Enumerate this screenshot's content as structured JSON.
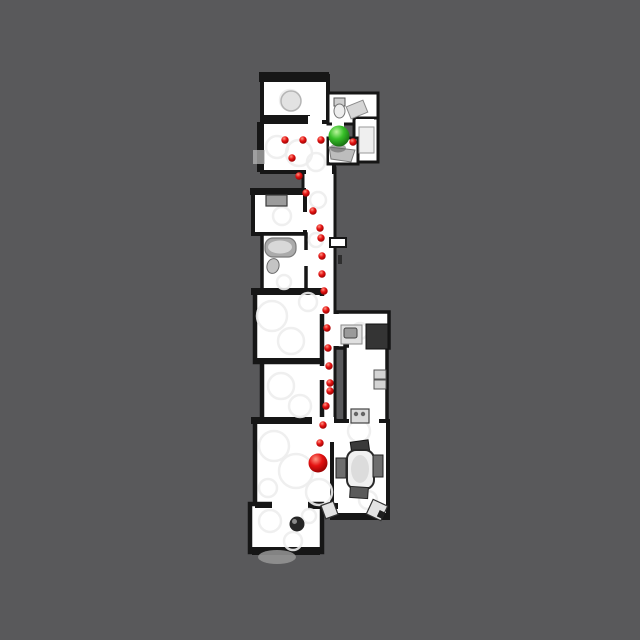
{
  "scene": {
    "canvas": {
      "w": 640,
      "h": 640,
      "background": "#59595b"
    },
    "floor_color": "#ffffff",
    "wall_color": "#161616",
    "artifact_color": "#ededed",
    "colors": {
      "path_red": {
        "hi": "#ff9582",
        "mid": "#e51212",
        "lo": "#8c0000"
      },
      "goal_green": {
        "hi": "#b9f59b",
        "mid": "#36bf28",
        "lo": "#14610f"
      }
    },
    "rooms": [
      {
        "name": "corridor",
        "x": 303,
        "y": 168,
        "w": 32,
        "h": 262,
        "sw": 3
      },
      {
        "name": "corridor-stub",
        "x": 330,
        "y": 238,
        "w": 16,
        "h": 9,
        "sw": 2
      },
      {
        "name": "upper-hall",
        "x": 262,
        "y": 122,
        "w": 72,
        "h": 50,
        "sw": 4
      },
      {
        "name": "top-bedroom",
        "x": 262,
        "y": 76,
        "w": 66,
        "h": 46,
        "sw": 4
      },
      {
        "name": "top-bathroom",
        "x": 328,
        "y": 93,
        "w": 50,
        "h": 31,
        "sw": 3
      },
      {
        "name": "bath-annex",
        "x": 354,
        "y": 118,
        "w": 24,
        "h": 44,
        "sw": 3
      },
      {
        "name": "hall-extension",
        "x": 328,
        "y": 138,
        "w": 30,
        "h": 26,
        "sw": 3
      },
      {
        "name": "left-small-room",
        "x": 253,
        "y": 193,
        "w": 52,
        "h": 41,
        "sw": 4
      },
      {
        "name": "left-bathroom",
        "x": 262,
        "y": 234,
        "w": 44,
        "h": 62,
        "sw": 3.5
      },
      {
        "name": "bedroom-a",
        "x": 255,
        "y": 292,
        "w": 67,
        "h": 70,
        "sw": 4.5
      },
      {
        "name": "bedroom-b",
        "x": 262,
        "y": 362,
        "w": 60,
        "h": 63,
        "sw": 4.5
      },
      {
        "name": "kitchen",
        "x": 337,
        "y": 312,
        "w": 52,
        "h": 36,
        "sw": 3.5
      },
      {
        "name": "laundry-hall",
        "x": 345,
        "y": 346,
        "w": 42,
        "h": 82,
        "sw": 3.5
      },
      {
        "name": "living-room",
        "x": 255,
        "y": 421,
        "w": 80,
        "h": 86,
        "sw": 4.5
      },
      {
        "name": "dining-room",
        "x": 332,
        "y": 421,
        "w": 56,
        "h": 97,
        "sw": 4
      },
      {
        "name": "lounge",
        "x": 250,
        "y": 504,
        "w": 72,
        "h": 48,
        "sw": 4.5
      }
    ],
    "wall_strips": [
      {
        "name": "wall-top-bedroom-top",
        "x": 259,
        "y": 72,
        "w": 70,
        "h": 10
      },
      {
        "name": "wall-top-bedroom-bottom",
        "x": 264,
        "y": 115,
        "w": 46,
        "h": 8
      },
      {
        "name": "wall-hall-left",
        "x": 257,
        "y": 122,
        "w": 7,
        "h": 50
      },
      {
        "name": "wall-left-small-top",
        "x": 250,
        "y": 188,
        "w": 56,
        "h": 7
      },
      {
        "name": "wall-bedroom-a-top",
        "x": 251,
        "y": 288,
        "w": 72,
        "h": 7
      },
      {
        "name": "wall-between-bedrooms",
        "x": 253,
        "y": 358,
        "w": 70,
        "h": 6
      },
      {
        "name": "wall-living-top",
        "x": 251,
        "y": 417,
        "w": 64,
        "h": 7
      },
      {
        "name": "wall-living-lounge",
        "x": 255,
        "y": 502,
        "w": 18,
        "h": 6
      },
      {
        "name": "wall-living-bottom-right",
        "x": 308,
        "y": 503,
        "w": 30,
        "h": 6
      },
      {
        "name": "wall-lounge-bottom",
        "x": 252,
        "y": 547,
        "w": 68,
        "h": 8
      },
      {
        "name": "wall-dining-bottom",
        "x": 333,
        "y": 513,
        "w": 56,
        "h": 7
      }
    ],
    "connectors": [
      {
        "name": "door-hall-corridor",
        "x": 306,
        "y": 166,
        "w": 26,
        "h": 10
      },
      {
        "name": "door-hall-ext",
        "x": 329,
        "y": 140,
        "w": 8,
        "h": 22
      },
      {
        "name": "door-bath-top",
        "x": 332,
        "y": 119,
        "w": 12,
        "h": 9
      },
      {
        "name": "door-annex",
        "x": 356,
        "y": 119,
        "w": 18,
        "h": 6
      },
      {
        "name": "door-top-bedroom",
        "x": 308,
        "y": 116,
        "w": 14,
        "h": 9
      },
      {
        "name": "door-left-small",
        "x": 301,
        "y": 212,
        "w": 8,
        "h": 18
      },
      {
        "name": "door-bath-left",
        "x": 302,
        "y": 250,
        "w": 8,
        "h": 16
      },
      {
        "name": "door-corridor-kitchen",
        "x": 331,
        "y": 314,
        "w": 10,
        "h": 32
      },
      {
        "name": "door-bedroom-a",
        "x": 318,
        "y": 296,
        "w": 8,
        "h": 18
      },
      {
        "name": "door-bedroom-b",
        "x": 318,
        "y": 366,
        "w": 8,
        "h": 14
      },
      {
        "name": "door-corridor-living",
        "x": 312,
        "y": 417,
        "w": 22,
        "h": 10
      },
      {
        "name": "door-laundry-kitchen",
        "x": 349,
        "y": 343,
        "w": 24,
        "h": 7
      },
      {
        "name": "door-laundry-dining",
        "x": 349,
        "y": 419,
        "w": 30,
        "h": 9
      },
      {
        "name": "door-living-dining",
        "x": 330,
        "y": 426,
        "w": 8,
        "h": 16
      },
      {
        "name": "door-living-lounge",
        "x": 272,
        "y": 500,
        "w": 36,
        "h": 9
      }
    ],
    "artifacts": [
      [
        277,
        147,
        11
      ],
      [
        299,
        153,
        13
      ],
      [
        316,
        162,
        9
      ],
      [
        290,
        100,
        10
      ],
      [
        282,
        216,
        9
      ],
      [
        284,
        282,
        7
      ],
      [
        272,
        316,
        15
      ],
      [
        291,
        341,
        13
      ],
      [
        308,
        302,
        9
      ],
      [
        281,
        386,
        13
      ],
      [
        300,
        406,
        11
      ],
      [
        274,
        446,
        15
      ],
      [
        296,
        471,
        17
      ],
      [
        319,
        492,
        13
      ],
      [
        268,
        488,
        9
      ],
      [
        359,
        431,
        11
      ],
      [
        368,
        500,
        9
      ],
      [
        270,
        521,
        11
      ],
      [
        293,
        541,
        9
      ],
      [
        309,
        516,
        7
      ],
      [
        360,
        331,
        8
      ],
      [
        318,
        200,
        8
      ],
      [
        316,
        240,
        7
      ]
    ],
    "furniture": [
      {
        "name": "ceiling-fan-top-bedroom",
        "type": "circle",
        "cx": 291,
        "cy": 101,
        "r": 10,
        "fill": "#e2e2e2",
        "stroke": "#b5b5b5",
        "sw": 1.5
      },
      {
        "name": "toilet-top-bath-tank",
        "type": "rect",
        "x": 334,
        "y": 98,
        "w": 11,
        "h": 8,
        "fill": "#cfcfcf",
        "stroke": "#555555",
        "sw": 1
      },
      {
        "name": "toilet-top-bath-bowl",
        "type": "ellipse",
        "cx": 339.5,
        "cy": 111,
        "rx": 5.5,
        "ry": 7,
        "fill": "#ededed",
        "stroke": "#777777",
        "sw": 1
      },
      {
        "name": "shower-top-bath",
        "type": "rect",
        "x": 348,
        "y": 103,
        "w": 18,
        "h": 13,
        "rot": -22,
        "fill": "#d6d6d6",
        "stroke": "#8a8a8a",
        "sw": 1
      },
      {
        "name": "vanity-annex",
        "type": "rect",
        "x": 359,
        "y": 127,
        "w": 15,
        "h": 26,
        "fill": "#efefef",
        "stroke": "#9a9a9a",
        "sw": 1
      },
      {
        "name": "step-shadow-hall-left",
        "type": "rect",
        "x": 253,
        "y": 150,
        "w": 12,
        "h": 14,
        "fill": "#bdbdbd",
        "opacity": 0.7
      },
      {
        "name": "bathtub-ledge-under-goal",
        "type": "polygon",
        "points": "329,147 355,150 351,162 331,159",
        "fill": "#bdbdbd",
        "stroke": "#7a7a7a",
        "sw": 1
      },
      {
        "name": "goal-shadow",
        "type": "ellipse",
        "cx": 338,
        "cy": 148,
        "rx": 8,
        "ry": 4.5,
        "fill": "#5f5f5f",
        "opacity": 0.55
      },
      {
        "name": "dresser-left-room",
        "type": "rect",
        "x": 266,
        "y": 195,
        "w": 21,
        "h": 11,
        "fill": "#9c9c9c",
        "stroke": "#3a3a3a",
        "sw": 1.2
      },
      {
        "name": "bathtub-left",
        "type": "rect",
        "x": 265,
        "y": 238,
        "w": 31,
        "h": 19,
        "rx": 8,
        "fill": "#ababab",
        "stroke": "#7a7a7a",
        "sw": 1.2
      },
      {
        "name": "bathtub-left-inner",
        "type": "ellipse",
        "cx": 280,
        "cy": 247,
        "rx": 12,
        "ry": 6.5,
        "fill": "#d8d8d8"
      },
      {
        "name": "toilet-left-bath",
        "type": "ellipse",
        "cx": 273,
        "cy": 266,
        "rx": 6,
        "ry": 7.5,
        "rot": 15,
        "fill": "#c4c4c4",
        "stroke": "#6a6a6a",
        "sw": 1
      },
      {
        "name": "wall-door-tick",
        "type": "rect",
        "x": 338,
        "y": 255,
        "w": 4,
        "h": 9,
        "fill": "#2e2e2e"
      },
      {
        "name": "kitchen-counter",
        "type": "rect",
        "x": 341,
        "y": 325,
        "w": 21,
        "h": 19,
        "fill": "#e0e0e0",
        "stroke": "#8a8a8a",
        "sw": 1
      },
      {
        "name": "kitchen-sink",
        "type": "rect",
        "x": 344,
        "y": 328,
        "w": 13,
        "h": 10,
        "rx": 2,
        "fill": "#9a9a9a",
        "stroke": "#444444",
        "sw": 1
      },
      {
        "name": "kitchen-dark-unit",
        "type": "rect",
        "x": 366,
        "y": 324,
        "w": 22,
        "h": 25,
        "fill": "#343434",
        "stroke": "#111111",
        "sw": 1
      },
      {
        "name": "panel-box-upper",
        "type": "rect",
        "x": 374,
        "y": 370,
        "w": 12,
        "h": 9,
        "fill": "#d4d4d4",
        "stroke": "#555555",
        "sw": 1
      },
      {
        "name": "panel-box-lower",
        "type": "rect",
        "x": 374,
        "y": 380,
        "w": 12,
        "h": 9,
        "fill": "#d4d4d4",
        "stroke": "#555555",
        "sw": 1
      },
      {
        "name": "washer",
        "type": "rect",
        "x": 351,
        "y": 409,
        "w": 18,
        "h": 14,
        "fill": "#dadada",
        "stroke": "#444444",
        "sw": 1.2
      },
      {
        "name": "washer-knob-left",
        "type": "circle",
        "cx": 356,
        "cy": 414,
        "r": 2.2,
        "fill": "#666666"
      },
      {
        "name": "washer-knob-right",
        "type": "circle",
        "cx": 363,
        "cy": 414,
        "r": 2.2,
        "fill": "#666666"
      },
      {
        "name": "dining-chair-top",
        "type": "rect",
        "x": 351,
        "y": 441,
        "w": 18,
        "h": 12,
        "rot": -8,
        "fill": "#3a3a3a",
        "stroke": "#141414",
        "sw": 1
      },
      {
        "name": "dining-table",
        "type": "rect",
        "x": 347,
        "y": 450,
        "w": 27,
        "h": 39,
        "rx": 9,
        "fill": "#f0f0f0",
        "stroke": "#2a2a2a",
        "sw": 2
      },
      {
        "name": "dining-table-shade",
        "type": "ellipse",
        "cx": 360,
        "cy": 469,
        "rx": 9,
        "ry": 14,
        "fill": "#dcdcdc"
      },
      {
        "name": "dining-chair-left",
        "type": "rect",
        "x": 336,
        "y": 458,
        "w": 10,
        "h": 20,
        "fill": "#6e6e6e",
        "stroke": "#222222",
        "sw": 1
      },
      {
        "name": "dining-chair-right",
        "type": "rect",
        "x": 373,
        "y": 455,
        "w": 10,
        "h": 22,
        "fill": "#6e6e6e",
        "stroke": "#222222",
        "sw": 1
      },
      {
        "name": "dining-chair-bottom",
        "type": "rect",
        "x": 350,
        "y": 487,
        "w": 18,
        "h": 11,
        "rot": 4,
        "fill": "#5a5a5a",
        "stroke": "#222222",
        "sw": 1
      },
      {
        "name": "dining-corner-chair-left",
        "type": "rect",
        "x": 323,
        "y": 503,
        "w": 13,
        "h": 14,
        "rot": -20,
        "fill": "#e3e3e3",
        "stroke": "#333333",
        "sw": 1.2
      },
      {
        "name": "dining-corner-chair-right",
        "type": "rect",
        "x": 369,
        "y": 502,
        "w": 16,
        "h": 16,
        "rot": 25,
        "fill": "#e3e3e3",
        "stroke": "#333333",
        "sw": 1.2
      },
      {
        "name": "corner-chair-dark-mark",
        "type": "rect",
        "x": 378,
        "y": 511,
        "w": 6,
        "h": 7,
        "rot": 25,
        "fill": "#1f1f1f"
      },
      {
        "name": "plant-lounge",
        "type": "circle",
        "cx": 297,
        "cy": 524,
        "r": 7.5,
        "fill": "#262626"
      },
      {
        "name": "plant-lounge-highlight",
        "type": "circle",
        "cx": 294.5,
        "cy": 521.5,
        "r": 2.5,
        "fill": "#8a8a8a"
      },
      {
        "name": "lounge-exterior-shadow",
        "type": "ellipse",
        "cx": 277,
        "cy": 557,
        "rx": 19,
        "ry": 7,
        "fill": "#969696",
        "opacity": 0.85
      }
    ],
    "path": {
      "dot_radius": 3.7,
      "waypoints": [
        [
          285,
          140
        ],
        [
          303,
          140
        ],
        [
          321,
          140
        ],
        [
          353,
          142
        ],
        [
          292,
          158
        ],
        [
          299,
          176
        ],
        [
          306,
          193
        ],
        [
          313,
          211
        ],
        [
          320,
          228
        ],
        [
          321,
          238
        ],
        [
          322,
          256
        ],
        [
          322,
          274
        ],
        [
          324,
          291
        ],
        [
          326,
          310
        ],
        [
          327,
          328
        ],
        [
          328,
          348
        ],
        [
          329,
          366
        ],
        [
          330,
          383
        ],
        [
          330,
          391
        ],
        [
          326,
          406
        ],
        [
          323,
          425
        ],
        [
          320,
          443
        ]
      ]
    },
    "start_marker": {
      "name": "start-sphere",
      "x": 318,
      "y": 463,
      "r": 9.5
    },
    "goal_marker": {
      "name": "goal-sphere",
      "x": 339,
      "y": 136,
      "r": 10.5
    }
  }
}
